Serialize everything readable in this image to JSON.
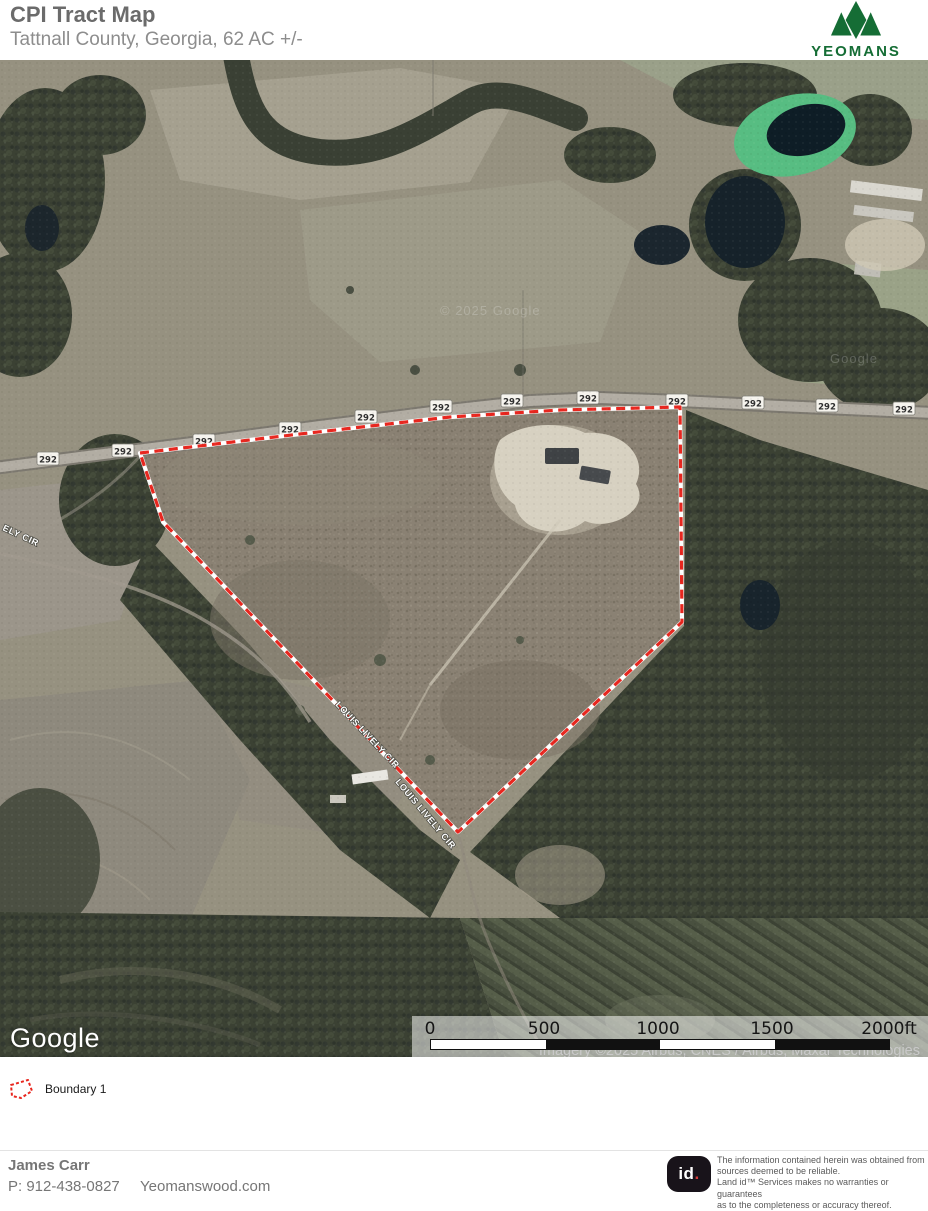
{
  "header": {
    "title": "CPI Tract Map",
    "subtitle": "Tattnall County, Georgia, 62 AC +/-"
  },
  "brand": {
    "name": "YEOMANS",
    "tagline": "WOOD & TIMBER",
    "color": "#156d35"
  },
  "map": {
    "shield": "292",
    "road_label_1": "LOUIS LIVELY CIR",
    "road_label_2": "LOUIS LIVELY CIR",
    "road_label_3": "ELY CIR",
    "watermark": "© 2025 Google",
    "watermark_2": "Google",
    "google_logo": "Google",
    "attribution": "Imagery ©2025 Airbus, CNES / Airbus, Maxar Technologies",
    "boundary_color": "#e8271f",
    "scale": {
      "t0": "0",
      "t1": "500",
      "t2": "1000",
      "t3": "1500",
      "t4": "2000ft"
    }
  },
  "legend": {
    "item": "Boundary 1"
  },
  "footer": {
    "name": "James Carr",
    "phone": "P: 912-438-0827",
    "website": "Yeomanswood.com",
    "land_id_mark": "id",
    "land_id_dot": ".",
    "disclaimer": "The information contained herein was obtained from\nsources deemed to be reliable.\n Land id™ Services makes no warranties or guarantees\nas to the completeness or accuracy thereof."
  }
}
